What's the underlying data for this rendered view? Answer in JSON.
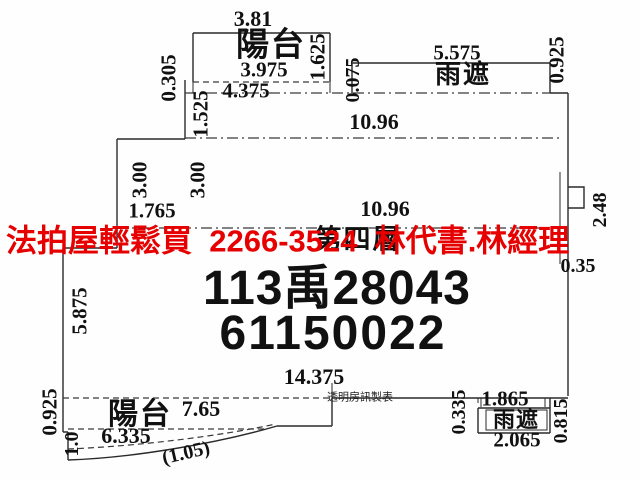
{
  "watermark": {
    "text": "法拍屋輕鬆買  2266-3524  林代書.林經理",
    "color": "#e60000"
  },
  "case_number": {
    "line1": "113禹28043",
    "line2": "61150022"
  },
  "floor": {
    "text": "第四層"
  },
  "producer": {
    "text": "透明房訊製表"
  },
  "plan": {
    "top_balcony": {
      "label": "陽台"
    },
    "top_awning": {
      "label": "雨遮"
    },
    "bottom_balcony": {
      "label": "陽台"
    },
    "bottom_awning": {
      "label": "雨遮"
    },
    "line_color": "#2a2a2a"
  },
  "dimensions": [
    {
      "id": "top-balcony-width-outer",
      "text": "3.81",
      "x": 253,
      "y": 19,
      "rot": 0,
      "fs": 22
    },
    {
      "id": "top-balcony-height",
      "text": "1.625",
      "x": 318,
      "y": 57,
      "rot": -90
    },
    {
      "id": "top-balcony-width-inner",
      "text": "3.975",
      "x": 264,
      "y": 70,
      "rot": 0
    },
    {
      "id": "offset-0305",
      "text": "0.305",
      "x": 169,
      "y": 78,
      "rot": -90
    },
    {
      "id": "width-4375",
      "text": "4.375",
      "x": 246,
      "y": 91,
      "rot": 0
    },
    {
      "id": "offset-0075",
      "text": "0.075",
      "x": 353,
      "y": 80,
      "rot": -90,
      "fs": 20
    },
    {
      "id": "height-1525",
      "text": "1.525",
      "x": 201,
      "y": 114,
      "rot": -90
    },
    {
      "id": "top-awning-width",
      "text": "5.575",
      "x": 457,
      "y": 53,
      "rot": 0
    },
    {
      "id": "top-awning-height",
      "text": "0.925",
      "x": 557,
      "y": 60,
      "rot": -90
    },
    {
      "id": "main-width-upper",
      "text": "10.96",
      "x": 374,
      "y": 122,
      "rot": 0,
      "fs": 22
    },
    {
      "id": "left-height-3a",
      "text": "3.00",
      "x": 140,
      "y": 180,
      "rot": -90
    },
    {
      "id": "left-height-3b",
      "text": "3.00",
      "x": 198,
      "y": 180,
      "rot": -90
    },
    {
      "id": "main-width-lower",
      "text": "10.96",
      "x": 385,
      "y": 209,
      "rot": 0,
      "fs": 22
    },
    {
      "id": "width-1765",
      "text": "1.765",
      "x": 152,
      "y": 211,
      "rot": 0
    },
    {
      "id": "right-height-248",
      "text": "2.48",
      "x": 600,
      "y": 210,
      "rot": -90,
      "fs": 20
    },
    {
      "id": "right-offset-035",
      "text": "0.35",
      "x": 578,
      "y": 266,
      "rot": 0,
      "fs": 20
    },
    {
      "id": "left-height-5875",
      "text": "5.875",
      "x": 80,
      "y": 311,
      "rot": -90
    },
    {
      "id": "bottom-width-14375",
      "text": "14.375",
      "x": 314,
      "y": 377,
      "rot": 0,
      "fs": 22
    },
    {
      "id": "bottom-balcony-height-0925",
      "text": "0.925",
      "x": 50,
      "y": 412,
      "rot": -90
    },
    {
      "id": "bottom-balcony-width-765",
      "text": "7.65",
      "x": 201,
      "y": 409,
      "rot": 0,
      "fs": 22
    },
    {
      "id": "bottom-balcony-width-6335",
      "text": "6.335",
      "x": 126,
      "y": 436,
      "rot": 0,
      "fs": 22
    },
    {
      "id": "bottom-balcony-height-10",
      "text": "1.0",
      "x": 72,
      "y": 444,
      "rot": -90,
      "fs": 20
    },
    {
      "id": "bottom-curve-105",
      "text": "(1.05)",
      "x": 186,
      "y": 453,
      "rot": -13,
      "fs": 20
    },
    {
      "id": "bottom-offset-0335",
      "text": "0.335",
      "x": 459,
      "y": 412,
      "rot": -90,
      "fs": 20
    },
    {
      "id": "bottom-awning-width-1865",
      "text": "1.865",
      "x": 505,
      "y": 399,
      "rot": 0
    },
    {
      "id": "bottom-awning-height-0815",
      "text": "0.815",
      "x": 561,
      "y": 421,
      "rot": -90,
      "fs": 20
    },
    {
      "id": "bottom-awning-width-2065",
      "text": "2.065",
      "x": 517,
      "y": 440,
      "rot": 0
    }
  ]
}
